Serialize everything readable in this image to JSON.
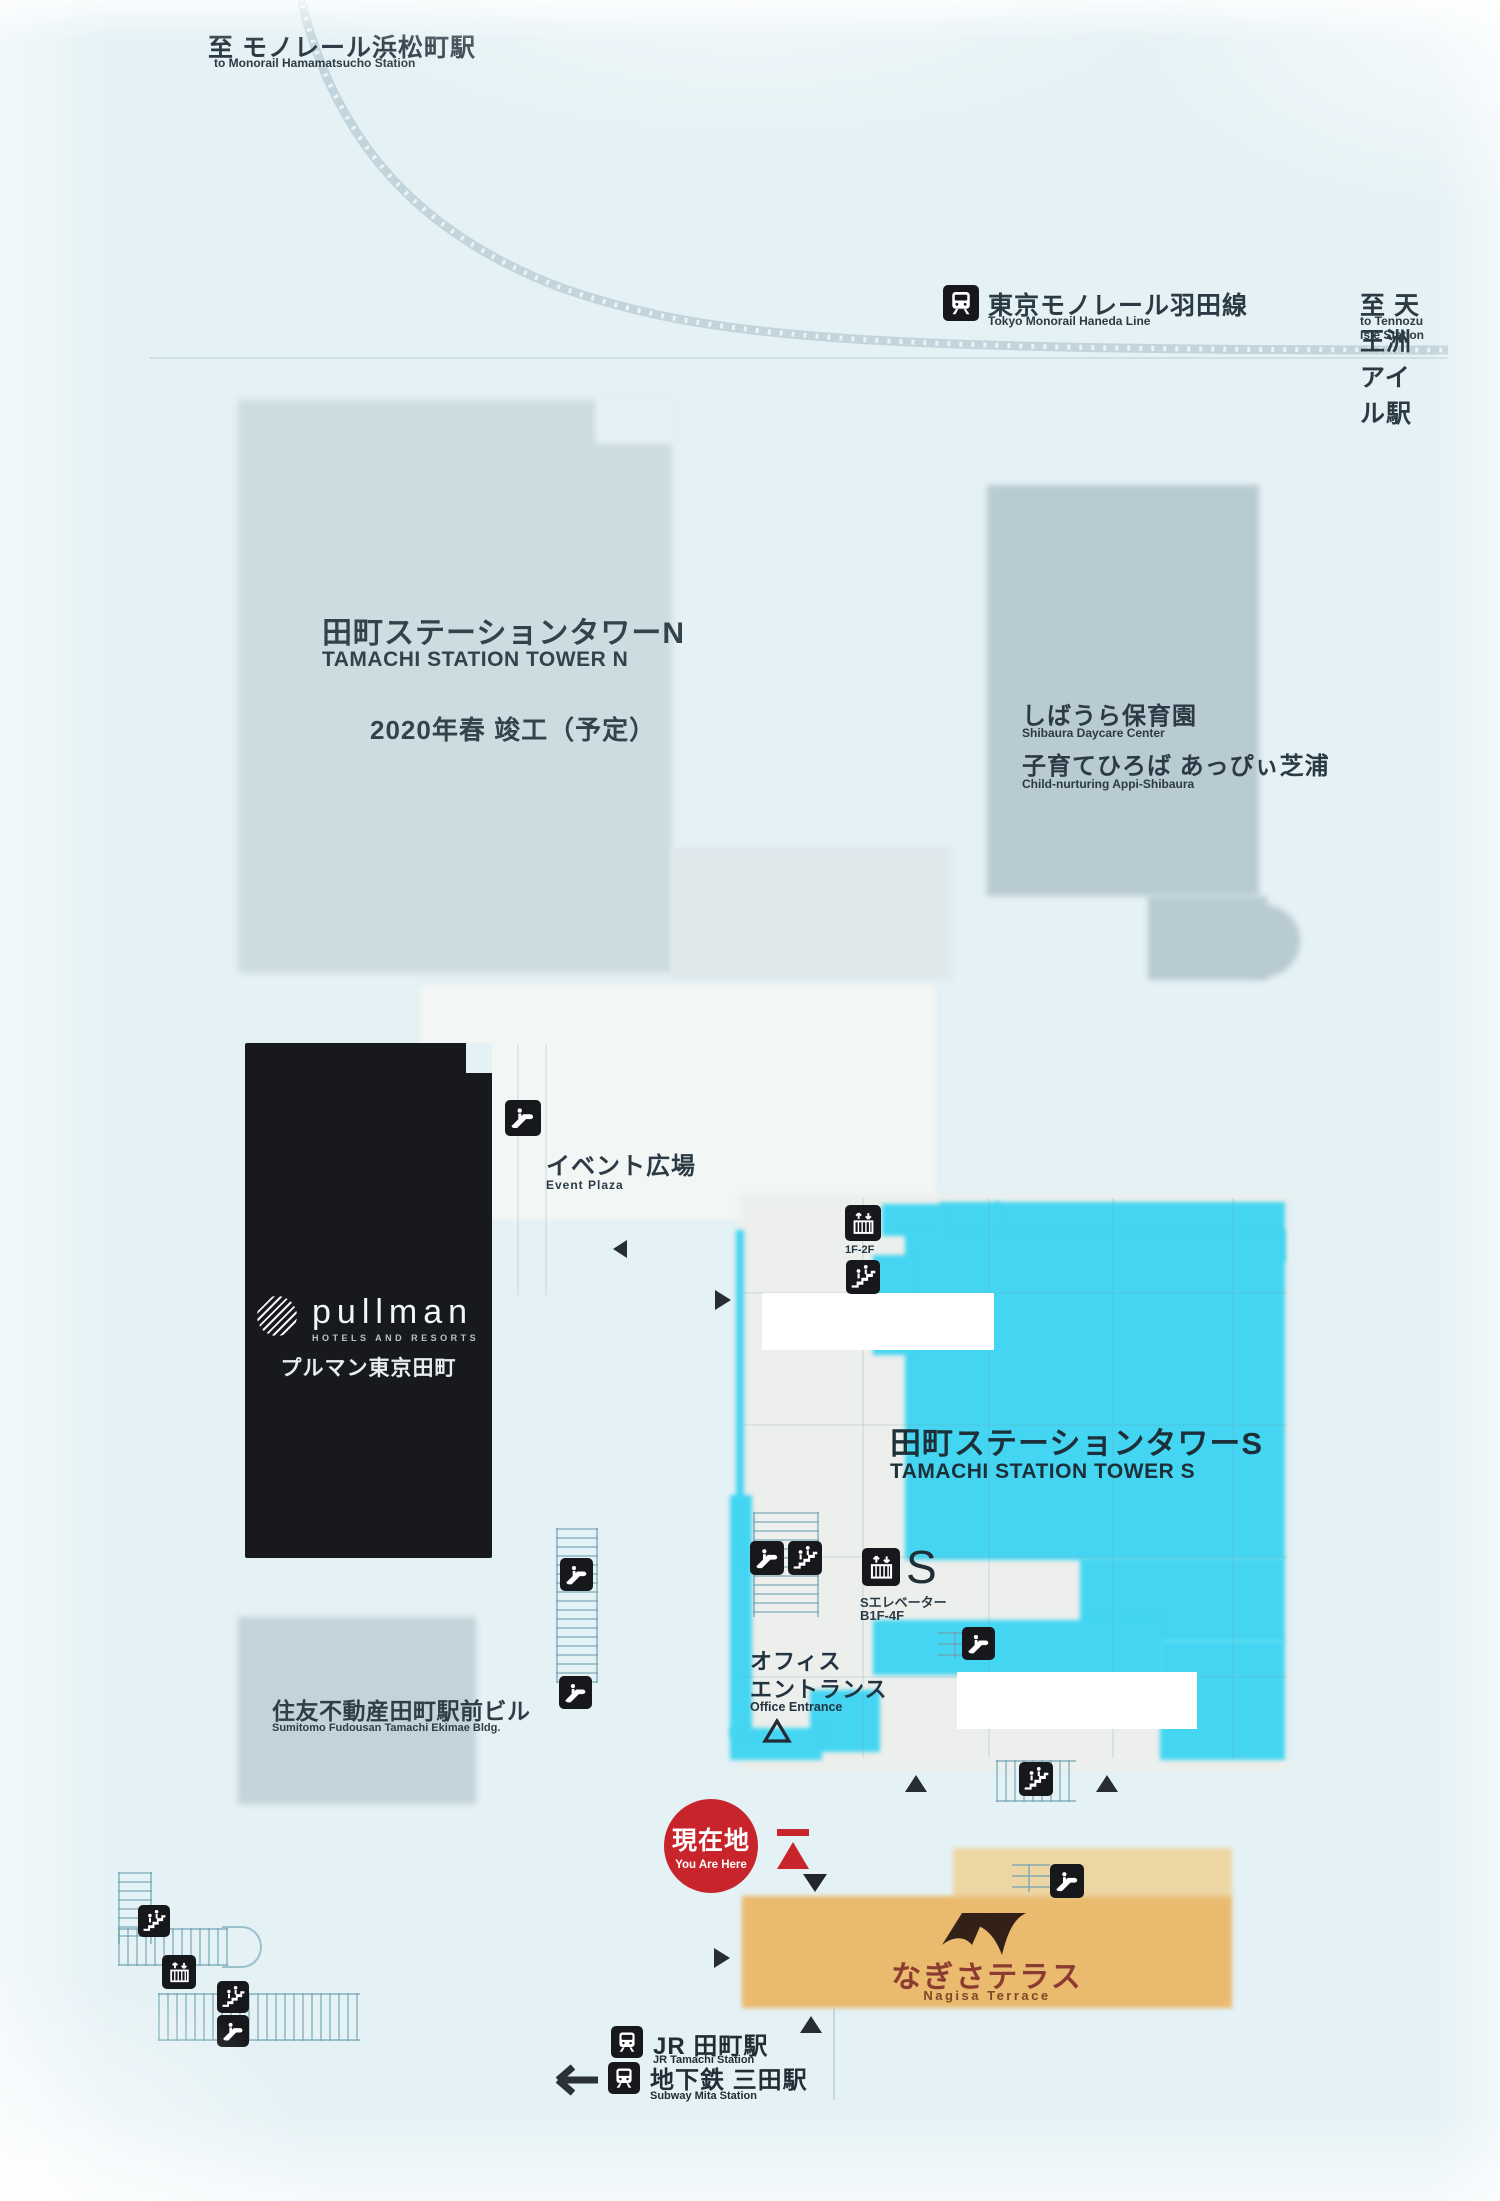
{
  "colors": {
    "background": "#e4f1f5",
    "cyan": "#43d5f1",
    "orange": "#eaba6e",
    "orange_light": "#ecd6a4",
    "red": "#c8242c",
    "black_building": "#17191d",
    "text_dark": "#25323c"
  },
  "top_left_station": {
    "ja": "至 モノレール浜松町駅",
    "en": "to Monorail Hamamatsucho Station"
  },
  "monorail_line": {
    "ja": "東京モノレール羽田線",
    "en": "Tokyo Monorail Haneda Line"
  },
  "top_right_station": {
    "ja": "至 天王洲アイル駅",
    "en": "to Tennozu Isle Station"
  },
  "tower_n": {
    "name_ja": "田町ステーションタワーN",
    "name_en": "TAMACHI STATION TOWER N",
    "completion": "2020年春 竣工（予定）"
  },
  "daycare": {
    "name_ja": "しばうら保育園",
    "name_en": "Shibaura Daycare Center",
    "sub_ja": "子育てひろば あっぴぃ芝浦",
    "sub_en": "Child-nurturing Appi-Shibaura"
  },
  "event_plaza": {
    "ja": "イベント広場",
    "en": "Event Plaza"
  },
  "pullman": {
    "brand": "pullman",
    "brand_sub": "HOTELS AND RESORTS",
    "name_ja": "プルマン東京田町"
  },
  "tower_s": {
    "name_ja": "田町ステーションタワーS",
    "name_en": "TAMACHI STATION TOWER S"
  },
  "s_elevator": {
    "letter": "S",
    "label_ja": "Sエレベーター",
    "floors": "B1F-4F"
  },
  "elevator_small": {
    "floors": "1F-2F"
  },
  "office_entrance": {
    "ja_line1": "オフィス",
    "ja_line2": "エントランス",
    "en": "Office Entrance"
  },
  "sumitomo": {
    "name_ja": "住友不動産田町駅前ビル",
    "name_en": "Sumitomo Fudousan Tamachi Ekimae Bldg."
  },
  "you_are_here": {
    "ja": "現在地",
    "en": "You Are Here"
  },
  "nagisa": {
    "name_ja": "なぎさテラス",
    "name_en": "Nagisa Terrace"
  },
  "stations": {
    "jr": {
      "ja": "JR 田町駅",
      "en": "JR Tamachi Station"
    },
    "subway": {
      "ja": "地下鉄 三田駅",
      "en": "Subway Mita Station"
    }
  },
  "icons": {
    "escalator": "escalator-icon",
    "stairs": "stairs-icon",
    "elevator": "elevator-icon",
    "train": "train-icon",
    "left_arrow": "←",
    "up_triangle": "▲",
    "down_triangle": "▼",
    "right_triangle": "▶",
    "left_triangle": "◀",
    "entrance_triangle": "△"
  }
}
